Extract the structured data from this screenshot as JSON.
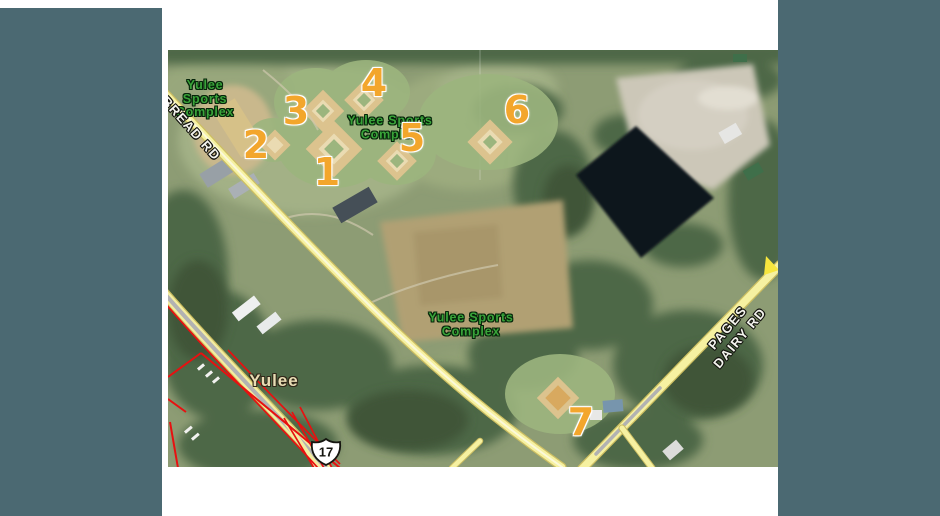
{
  "page": {
    "background_color": "#ffffff",
    "panel_color": "#4b6972"
  },
  "map": {
    "complex_labels": [
      {
        "id": "complex-label-top-left",
        "lines": [
          "Yulee",
          "Sports",
          "Complex"
        ],
        "x": 37,
        "y": 49,
        "rotate": 0
      },
      {
        "id": "complex-label-center",
        "lines": [
          "Yulee Sports",
          "Complex"
        ],
        "x": 222,
        "y": 78,
        "rotate": 0
      },
      {
        "id": "complex-label-bottom",
        "lines": [
          "Yulee Sports",
          "Complex"
        ],
        "x": 303,
        "y": 275,
        "rotate": 0
      }
    ],
    "road_labels": [
      {
        "id": "road-label-bread-rd",
        "lines": [
          "BREAD RD"
        ],
        "x": 23,
        "y": 79,
        "rotate": 48
      },
      {
        "id": "road-label-pages-dairy-rd",
        "lines": [
          "PAGES",
          "DAIRY RD"
        ],
        "x": 566,
        "y": 283,
        "rotate": -50
      }
    ],
    "town_label": {
      "text": "Yulee",
      "x": 106,
      "y": 331
    },
    "route_shield": {
      "number": "17",
      "x": 158,
      "y": 402
    },
    "field_markers": [
      {
        "number": "1",
        "x": 159,
        "y": 122
      },
      {
        "number": "2",
        "x": 88,
        "y": 95
      },
      {
        "number": "3",
        "x": 128,
        "y": 61
      },
      {
        "number": "4",
        "x": 206,
        "y": 33
      },
      {
        "number": "5",
        "x": 244,
        "y": 88
      },
      {
        "number": "6",
        "x": 349,
        "y": 60
      },
      {
        "number": "7",
        "x": 413,
        "y": 372
      }
    ],
    "colors": {
      "marker": "#f3a62c",
      "complex_label": "#39a339",
      "road_fill": "#f6f1a1",
      "highway_center": "#b2b2b2",
      "boundary_red": "#e81010",
      "pond_water": "#0d141b"
    }
  }
}
